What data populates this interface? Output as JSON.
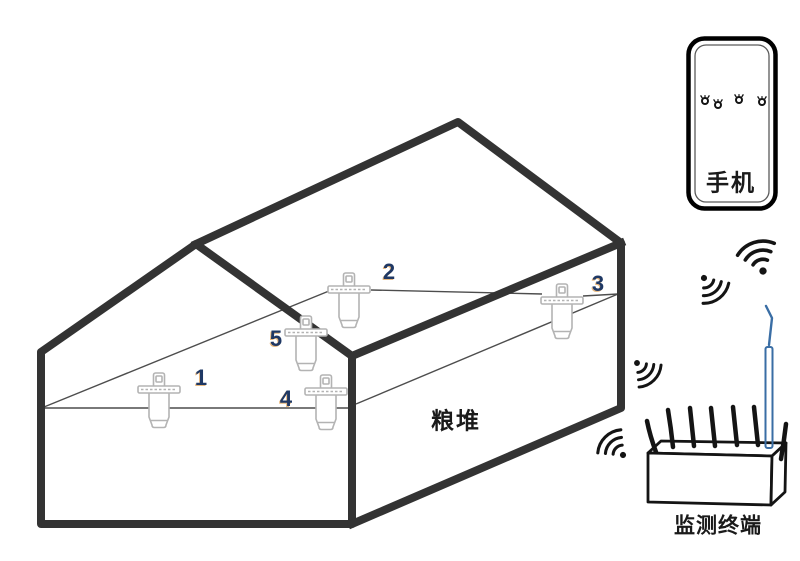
{
  "diagram": {
    "grain_pile_label": "粮堆",
    "phone_label": "手机",
    "terminal_label": "监测终端",
    "sensors": [
      {
        "label": "1"
      },
      {
        "label": "2"
      },
      {
        "label": "3"
      },
      {
        "label": "4"
      },
      {
        "label": "5"
      }
    ],
    "icons": [
      "sensor-probe-icon",
      "wifi-signal-icon",
      "bug-icon",
      "antenna-icon"
    ]
  },
  "colors": {
    "outline": "#333333",
    "thin-line": "#4d4d4d",
    "sensor-stroke": "#b3b3b3",
    "number": "#1f3864",
    "number-fringe": "#e7b87f",
    "antenna-blue": "#3a6ea5",
    "ink": "#141414"
  }
}
